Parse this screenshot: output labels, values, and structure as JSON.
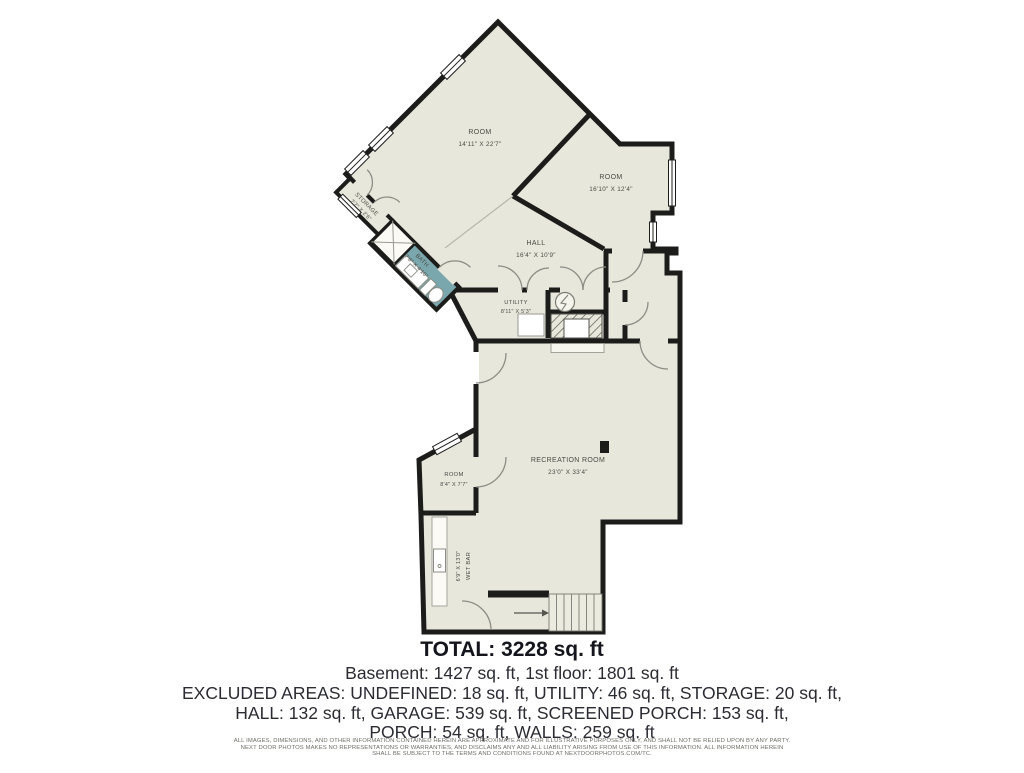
{
  "rooms": {
    "top_room": {
      "name": "ROOM",
      "dims": "14'11\" X 22'7\""
    },
    "right_room": {
      "name": "ROOM",
      "dims": "16'10\" X 12'4\""
    },
    "storage": {
      "name": "STORAGE",
      "dims": "7'7\" X 2'6\""
    },
    "bath": {
      "name": "BATH",
      "dims": "7'6\" X 4'10\""
    },
    "hall": {
      "name": "HALL",
      "dims": "16'4\" X 10'9\""
    },
    "utility": {
      "name": "UTILITY",
      "dims": "8'11\" X 5'3\""
    },
    "recreation": {
      "name": "RECREATION ROOM",
      "dims": "23'0\" X 33'4\""
    },
    "small_room": {
      "name": "ROOM",
      "dims": "8'4\" X 7'7\""
    },
    "wet_bar": {
      "name": "WET BAR",
      "dims": "6'9\" X 13'0\""
    }
  },
  "summary": {
    "total": "TOTAL: 3228 sq. ft",
    "floors": "Basement: 1427 sq. ft, 1st floor: 1801 sq. ft",
    "excluded1": "EXCLUDED AREAS: UNDEFINED: 18 sq. ft, UTILITY: 46 sq. ft, STORAGE: 20 sq. ft,",
    "excluded2": "HALL: 132 sq. ft, GARAGE: 539 sq. ft, SCREENED PORCH: 153 sq. ft,",
    "excluded3": "PORCH: 54 sq. ft, WALLS: 259 sq. ft"
  },
  "disclaimer": {
    "line1": "ALL IMAGES, DIMENSIONS, AND OTHER INFORMATION CONTAINED HEREIN ARE APPROXIMATE AND FOR ILLUSTRATIVE PURPOSES ONLY, AND SHALL NOT BE RELIED UPON BY ANY PARTY.",
    "line2": "NEXT DOOR PHOTOS MAKES NO REPRESENTATIONS OR WARRANTIES, AND DISCLAIMS ANY AND ALL LIABILITY ARISING FROM USE OF THIS INFORMATION. ALL INFORMATION HEREIN",
    "line3": "SHALL BE SUBJECT TO THE TERMS AND CONDITIONS FOUND AT NEXTDOORPHOTOS.COM/TC."
  },
  "colors": {
    "floor": "#e8e7dc",
    "wall": "#1c1c1b",
    "bath": "#7aa7ad"
  }
}
